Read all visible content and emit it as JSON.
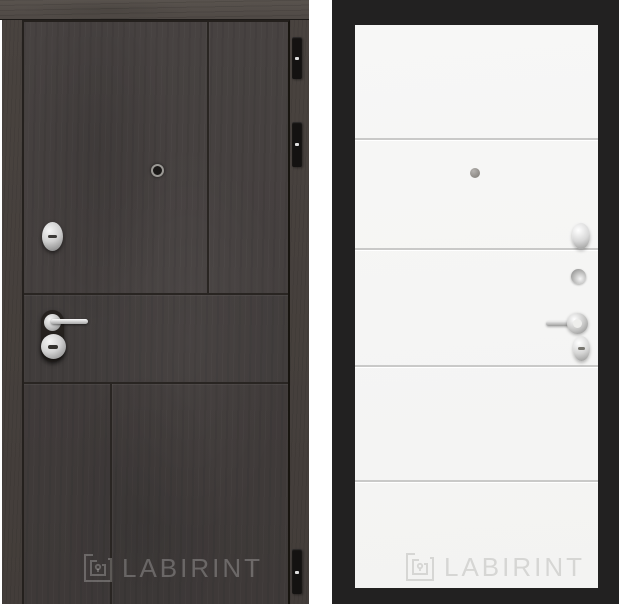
{
  "page": {
    "background": "#ffffff"
  },
  "left_door": {
    "logo_text": "LABIRINT",
    "hinge_count": 3,
    "hardware_icons": [
      "peephole-icon",
      "cylinder-lock-icon",
      "lever-handle-icon",
      "keyhole-escutcheon-icon",
      "hinge-icon"
    ],
    "colors": {
      "leaf": "#474241",
      "lintel": "#59534e",
      "jamb": "#49433f",
      "seam": "#292522",
      "hinge": "#141211",
      "logo": "rgba(255,255,255,0.24)"
    }
  },
  "right_door": {
    "logo_text": "LABIRINT",
    "groove_count": 4,
    "hardware_icons": [
      "peephole-icon",
      "oval-knob-icon",
      "thumbturn-icon",
      "lever-handle-icon",
      "keyhole-escutcheon-icon"
    ],
    "colors": {
      "frame": "#222121",
      "panel": "#f6f6f5",
      "groove": "#c9c9c8",
      "logo": "#d6d6d4"
    }
  }
}
